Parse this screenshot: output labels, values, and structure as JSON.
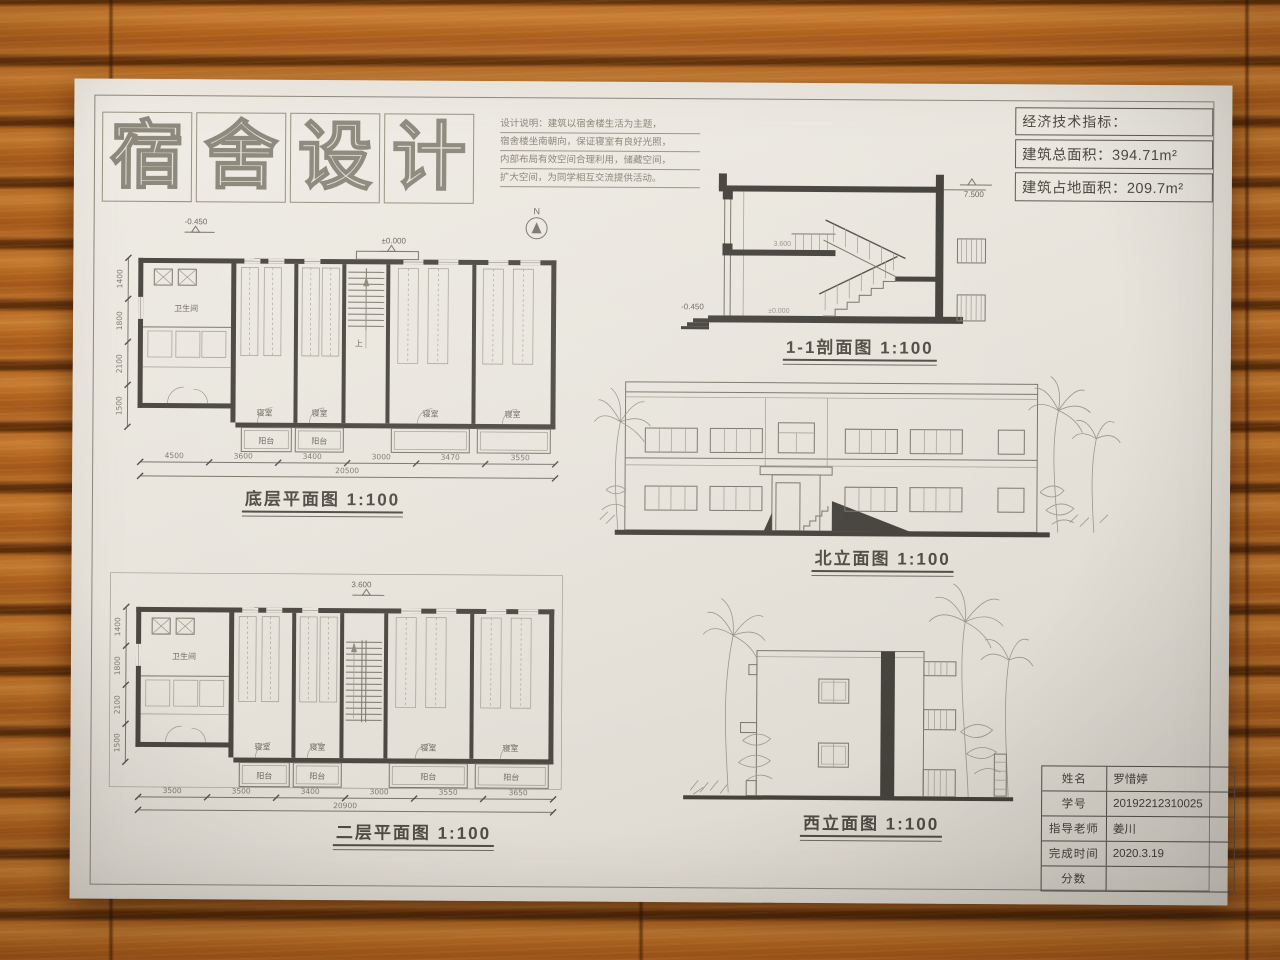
{
  "sheet": {
    "title_chars": [
      "宿",
      "舍",
      "设",
      "计"
    ],
    "compass_label": "N"
  },
  "design_notes": {
    "lines": [
      "设计说明：建筑以宿舍楼生活为主题，",
      "宿舍楼坐南朝向，保证寝室有良好光照，",
      "内部布局有效空间合理利用，储藏空间，",
      "扩大空间，为同学相互交流提供活动。"
    ]
  },
  "indicators": {
    "title": "经济技术指标：",
    "rows": [
      {
        "label": "建筑总面积：",
        "value": "394.71m²"
      },
      {
        "label": "建筑占地面积：",
        "value": "209.7m²"
      }
    ]
  },
  "plans": {
    "room_labels": {
      "bedroom": "寝室",
      "balcony": "阳台",
      "bathroom": "卫生间"
    },
    "stair_label": "上",
    "ground": {
      "caption": "底层平面图 1:100",
      "markers": {
        "entry": "-0.450",
        "level": "±0.000"
      },
      "dims": [
        "4500",
        "3600",
        "3400",
        "3000",
        "3470",
        "3550"
      ],
      "dims_total": "20500",
      "vdims": [
        "1400",
        "1800",
        "2100",
        "1500"
      ]
    },
    "second": {
      "caption": "二层平面图 1:100",
      "markers": {
        "level": "3.600"
      },
      "dims": [
        "3500",
        "3500",
        "3400",
        "3000",
        "3550",
        "3650"
      ],
      "dims_total": "20900",
      "vdims": [
        "1400",
        "1800",
        "2100",
        "1500"
      ]
    }
  },
  "section": {
    "caption": "1-1剖面图 1:100",
    "markers": {
      "top": "7.500",
      "mid": "3.600",
      "ground": "±0.000",
      "entry": "-0.450"
    }
  },
  "elevations": {
    "north": {
      "caption": "北立面图 1:100"
    },
    "west": {
      "caption": "西立面图 1:100"
    }
  },
  "title_block": {
    "rows": [
      {
        "label": "姓名",
        "value": "罗惜婷"
      },
      {
        "label": "学号",
        "value": "20192212310025"
      },
      {
        "label": "指导老师",
        "value": "姜川"
      },
      {
        "label": "完成时间",
        "value": "2020.3.19"
      },
      {
        "label": "分数",
        "value": ""
      }
    ]
  }
}
